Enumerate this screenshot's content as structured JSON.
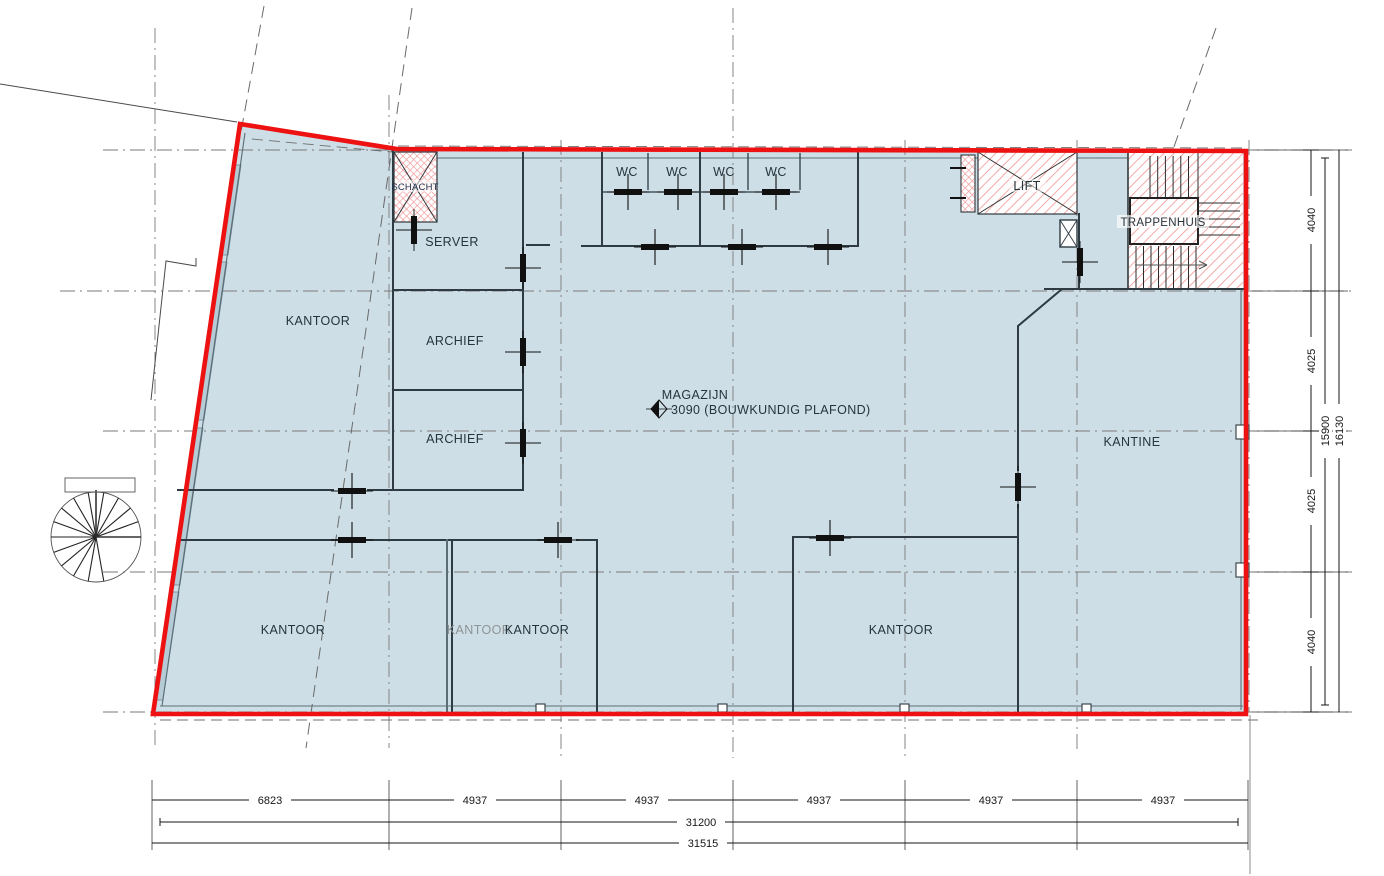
{
  "drawing": {
    "type": "architectural-floor-plan",
    "rooms": {
      "kantoor_nw": "KANTOOR",
      "server": "SERVER",
      "archief_1": "ARCHIEF",
      "archief_2": "ARCHIEF",
      "magazijn": "MAGAZIJN",
      "magazijn_ceiling": "3090 (BOUWKUNDIG PLAFOND)",
      "kantine": "KANTINE",
      "kantoor_sw": "KANTOOR",
      "kantoor_s_gray": "KANTOOR",
      "kantoor_s": "KANTOOR",
      "kantoor_se": "KANTOOR",
      "schacht": "SCHACHT",
      "lift": "LIFT",
      "trappenhuis": "TRAPPENHUIS",
      "wc": [
        "WC",
        "WC",
        "WC",
        "WC"
      ]
    },
    "dimensions": {
      "bottom_segments": [
        "6823",
        "4937",
        "4937",
        "4937",
        "4937",
        "4937"
      ],
      "bottom_total_inner": "31200",
      "bottom_total_outer": "31515",
      "right_segments": [
        "4040",
        "4025",
        "4025",
        "4040"
      ],
      "right_total_inner": "15900",
      "right_total_outer": "16130"
    },
    "colors": {
      "outline": "#ee1111",
      "room_fill": "#cddee6",
      "hatch": "#f19b9b",
      "wall": "#2e3b42",
      "grid": "#7a7a7a",
      "text": "#26343c"
    }
  }
}
